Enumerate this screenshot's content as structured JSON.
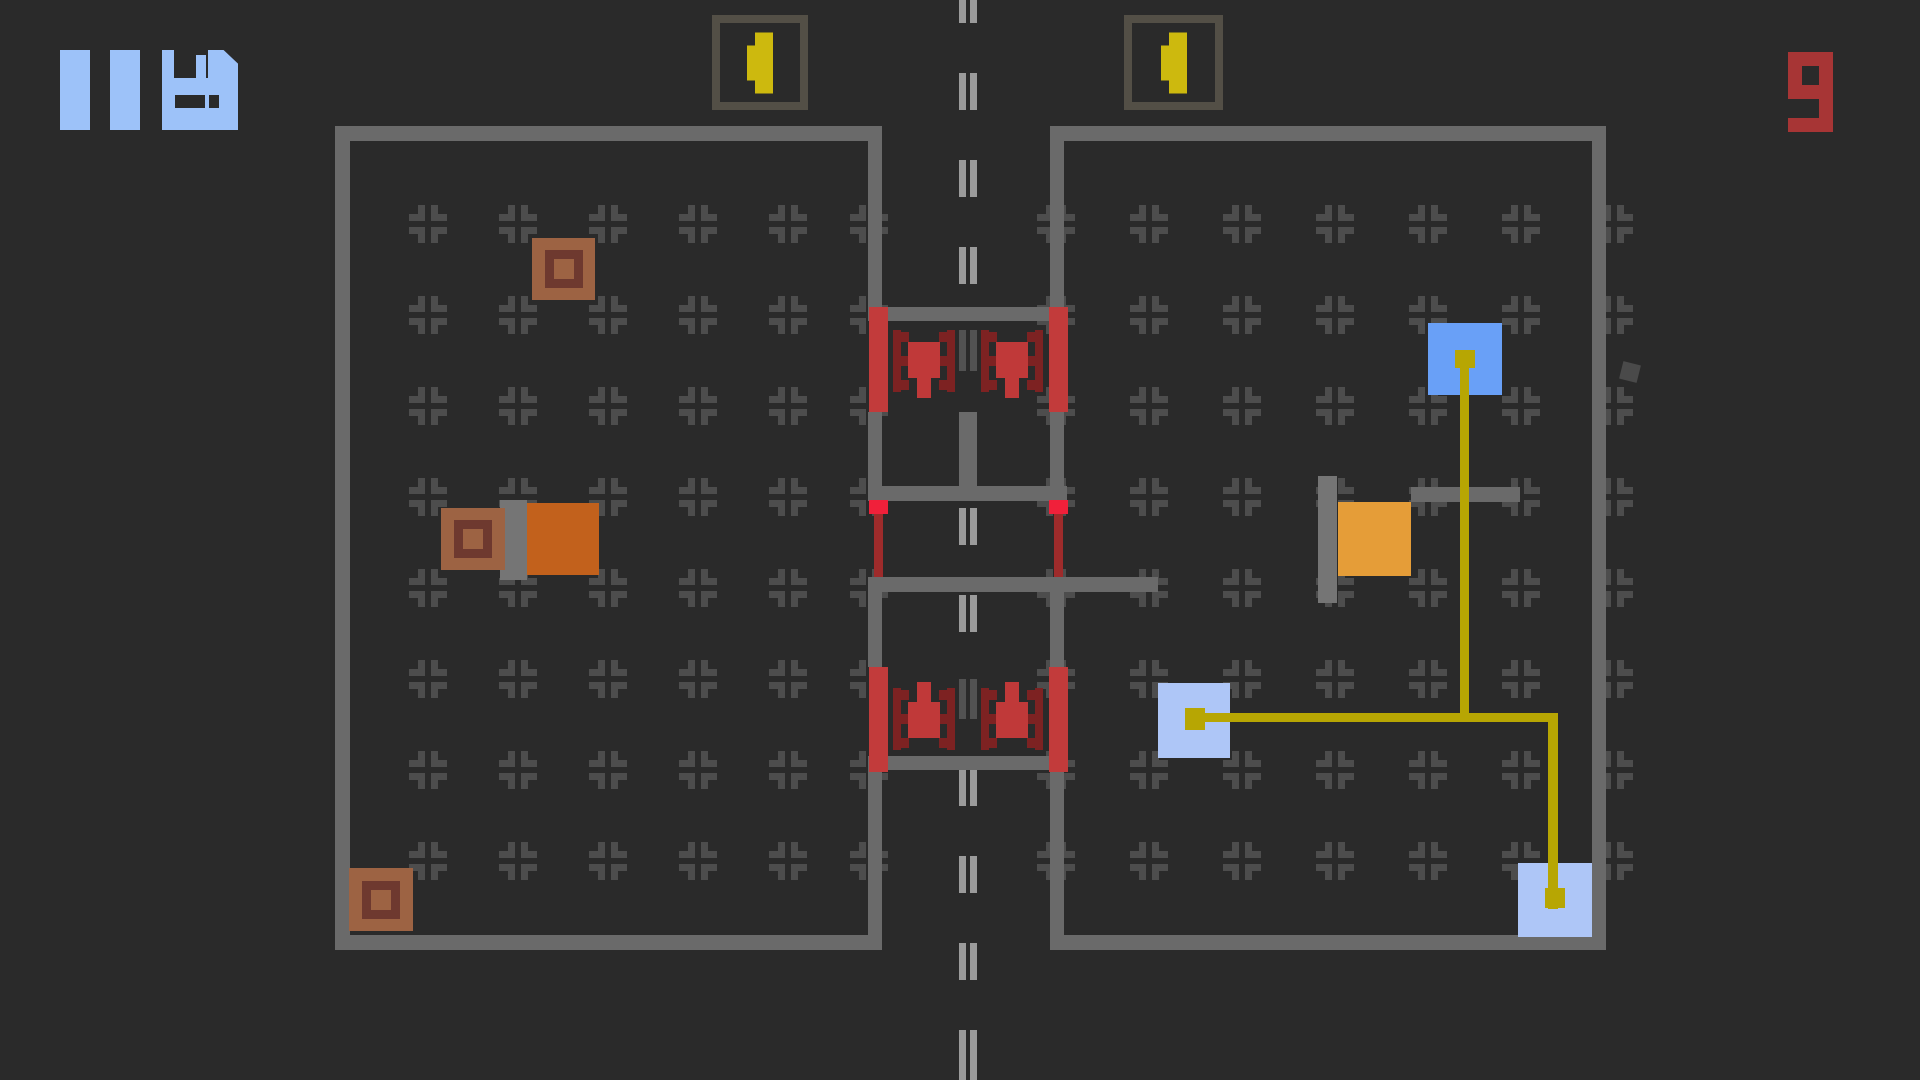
{
  "colors": {
    "bg": "#2a2a2a",
    "wall": "#6a6a6a",
    "mark": "#4d4d4d",
    "roadDash": "#9b9b9b",
    "roadDashDim": "#525252",
    "connector": "#757575",
    "hudBlue": "#9dc2f9",
    "counterRed": "#a73535",
    "postRed": "#c23b3b",
    "turretBody": "#c03939",
    "turretTrack": "#7d2222",
    "pinCap": "#f0203a",
    "pinStem": "#9e2b2b",
    "flagYellow": "#cdb90e",
    "boxOutline": "#534f46",
    "pathYellow": "#b7a603",
    "blueSolid": "#69a0f7",
    "bluePale": "#aec6f7",
    "orange": "#c2611c",
    "amber": "#e59d38",
    "crateFill": "#9d6343",
    "crateRing": "#6e392f",
    "speck": "#4a4a4a"
  },
  "hud": {
    "pause_icon": "pause-icon",
    "save_icon": "floppy-disk-icon",
    "counter_value": "9"
  },
  "scene": {
    "width": 1920,
    "height": 1080,
    "objects": [
      {
        "t": "marks",
        "name": "floor-marker-grid",
        "i": false,
        "cols": [
          428,
          518,
          608,
          698,
          788,
          869,
          1056,
          1149,
          1242,
          1335,
          1428,
          1521,
          1614
        ],
        "rows": [
          224,
          315,
          406,
          497,
          588,
          679,
          770,
          861
        ],
        "size": 38,
        "arm": 16,
        "thick": 7
      },
      {
        "t": "dash",
        "name": "road-centerline",
        "i": false,
        "x": 959,
        "y": 0,
        "w": 18,
        "h": 1080,
        "dashW": 7,
        "gap": 4,
        "dashH": 37,
        "period": 87,
        "phase": -14,
        "colorKey": "roadDash"
      },
      {
        "t": "rects",
        "name": "wall",
        "i": false,
        "colorKey": "wall",
        "items": [
          [
            335,
            126,
            547,
            15
          ],
          [
            335,
            126,
            15,
            824
          ],
          [
            335,
            935,
            547,
            15
          ],
          [
            868,
            126,
            14,
            181
          ],
          [
            868,
            412,
            14,
            75
          ],
          [
            868,
            592,
            14,
            75
          ],
          [
            868,
            770,
            14,
            165
          ],
          [
            1050,
            126,
            556,
            15
          ],
          [
            1592,
            126,
            14,
            824
          ],
          [
            1050,
            935,
            556,
            15
          ],
          [
            1050,
            126,
            14,
            181
          ],
          [
            1050,
            412,
            14,
            75
          ],
          [
            1050,
            592,
            14,
            75
          ],
          [
            1050,
            770,
            14,
            165
          ],
          [
            868,
            307,
            195,
            14
          ],
          [
            868,
            756,
            195,
            14
          ],
          [
            959,
            412,
            18,
            80
          ],
          [
            868,
            486,
            199,
            15
          ],
          [
            868,
            577,
            290,
            15
          ],
          [
            1411,
            487,
            109,
            15
          ]
        ]
      },
      {
        "t": "dash",
        "name": "road-centerline-dim",
        "i": false,
        "x": 959,
        "y": 321,
        "w": 18,
        "h": 91,
        "dashW": 7,
        "gap": 4,
        "dashH": 37,
        "period": 87,
        "phase": 13,
        "colorKey": "roadDashDim",
        "bgFill": true
      },
      {
        "t": "dash",
        "name": "road-centerline-dim",
        "i": false,
        "x": 959,
        "y": 665,
        "w": 18,
        "h": 90,
        "dashW": 7,
        "gap": 4,
        "dashH": 37,
        "period": 87,
        "phase": 17,
        "colorKey": "roadDashDim",
        "bgFill": true
      },
      {
        "t": "rects",
        "name": "dock-bar",
        "i": true,
        "colorKey": "connector",
        "items": [
          [
            500,
            500,
            27,
            80
          ],
          [
            1318,
            476,
            19,
            127
          ]
        ]
      },
      {
        "t": "rect",
        "name": "machine-block-orange",
        "i": true,
        "colorKey": "orange",
        "x": 527,
        "y": 503,
        "w": 72,
        "h": 72
      },
      {
        "t": "rect",
        "name": "machine-block-amber",
        "i": true,
        "colorKey": "amber",
        "x": 1338,
        "y": 502,
        "w": 73,
        "h": 74
      },
      {
        "t": "crate",
        "name": "resource-crate",
        "i": true,
        "x": 532,
        "y": 238,
        "w": 63,
        "h": 62
      },
      {
        "t": "crate",
        "name": "resource-crate",
        "i": true,
        "x": 441,
        "y": 508,
        "w": 64,
        "h": 62
      },
      {
        "t": "crate",
        "name": "resource-crate",
        "i": true,
        "x": 349,
        "y": 868,
        "w": 64,
        "h": 63
      },
      {
        "t": "rect",
        "name": "storage-block-blue",
        "i": true,
        "colorKey": "blueSolid",
        "x": 1428,
        "y": 323,
        "w": 74,
        "h": 72
      },
      {
        "t": "rect",
        "name": "storage-block-pale",
        "i": true,
        "colorKey": "bluePale",
        "x": 1158,
        "y": 683,
        "w": 72,
        "h": 75
      },
      {
        "t": "rect",
        "name": "storage-block-pale",
        "i": true,
        "colorKey": "bluePale",
        "x": 1518,
        "y": 863,
        "w": 74,
        "h": 74
      },
      {
        "t": "rects",
        "name": "conveyor-line",
        "i": false,
        "colorKey": "pathYellow",
        "items": [
          [
            1460,
            366,
            9,
            356
          ],
          [
            1195,
            713,
            363,
            9
          ],
          [
            1548,
            713,
            10,
            196
          ]
        ]
      },
      {
        "t": "rects",
        "name": "conveyor-node",
        "i": false,
        "colorKey": "pathYellow",
        "items": [
          [
            1455,
            350,
            20,
            18
          ],
          [
            1185,
            708,
            20,
            22
          ],
          [
            1545,
            888,
            20,
            20
          ]
        ]
      },
      {
        "t": "pin",
        "name": "barrier-emitter",
        "i": true,
        "x": 869,
        "y": 500
      },
      {
        "t": "pin",
        "name": "barrier-emitter",
        "i": true,
        "x": 1049,
        "y": 500
      },
      {
        "t": "rects",
        "name": "gate-post",
        "i": true,
        "colorKey": "postRed",
        "items": [
          [
            869,
            307,
            19,
            105
          ],
          [
            1049,
            307,
            19,
            105
          ],
          [
            869,
            667,
            19,
            105
          ],
          [
            1049,
            667,
            19,
            105
          ]
        ]
      },
      {
        "t": "turret",
        "name": "turret-down",
        "i": true,
        "x": 893,
        "y": 330,
        "dir": "down"
      },
      {
        "t": "turret",
        "name": "turret-down",
        "i": true,
        "x": 981,
        "y": 330,
        "dir": "down"
      },
      {
        "t": "turret",
        "name": "turret-up",
        "i": true,
        "x": 893,
        "y": 682,
        "dir": "up"
      },
      {
        "t": "turret",
        "name": "turret-up",
        "i": true,
        "x": 981,
        "y": 682,
        "dir": "up"
      },
      {
        "t": "rect",
        "name": "debris",
        "i": false,
        "colorKey": "speck",
        "x": 1621,
        "y": 363,
        "w": 18,
        "h": 18,
        "rot": 14
      },
      {
        "t": "flagbox",
        "name": "flag-slot",
        "i": true,
        "x": 712,
        "y": 15,
        "w": 96,
        "h": 95
      },
      {
        "t": "flagbox",
        "name": "flag-slot",
        "i": true,
        "x": 1124,
        "y": 15,
        "w": 99,
        "h": 95
      }
    ]
  }
}
